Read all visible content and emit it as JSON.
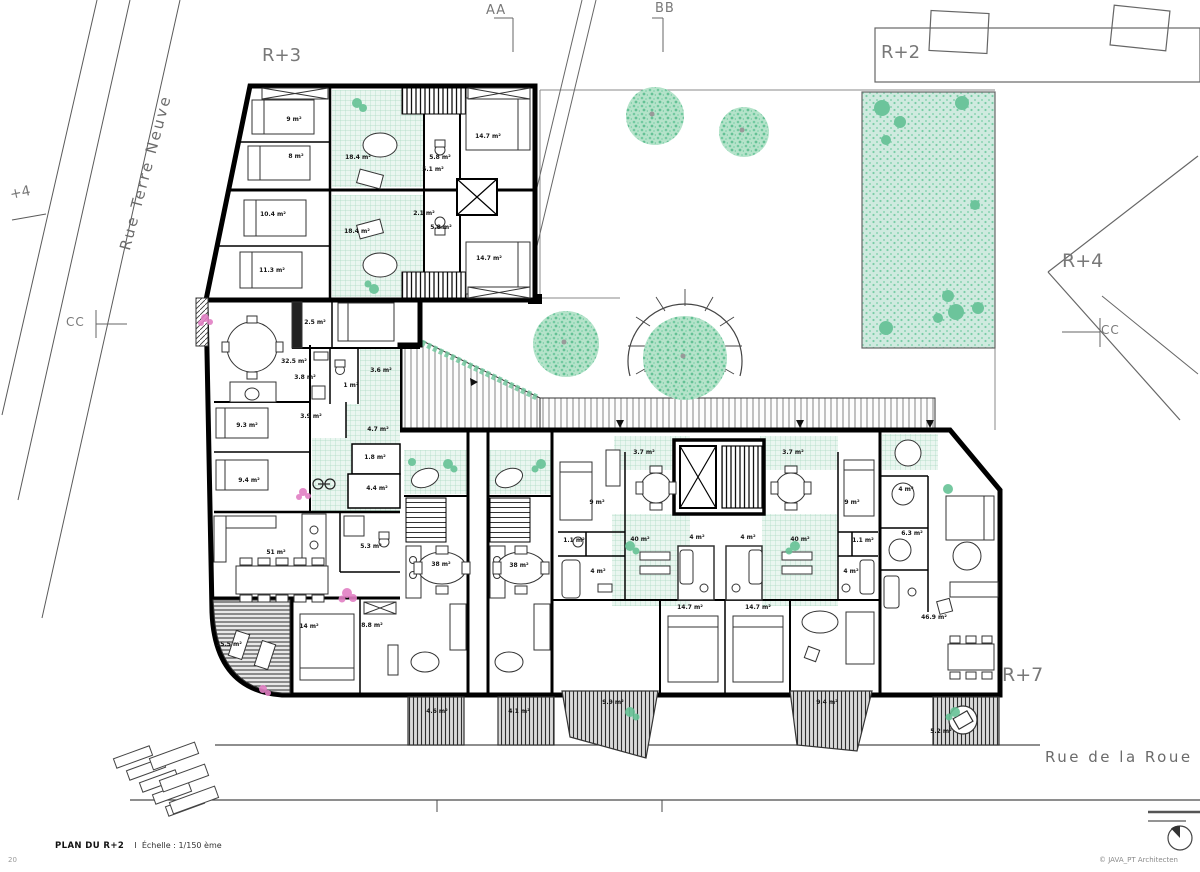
{
  "title_block": {
    "plan_title": "PLAN DU R+2",
    "separator": "I",
    "scale_label": "Échelle : 1/150 ème",
    "page_number": "20",
    "copyright": "© JAVA_PT Architecten"
  },
  "streets": {
    "left_street": "Rue Terre Neuve",
    "bottom_street": "Rue de la Roue"
  },
  "annotations": {
    "section_aa": "AA",
    "section_bb": "BB",
    "section_cc_left": "CC",
    "section_cc_right": "CC",
    "neighbor_r3": "R+3",
    "neighbor_r2": "R+2",
    "neighbor_r4": "R+4",
    "neighbor_r7": "R+7",
    "level_plus4": "+4"
  },
  "icons": {
    "compass": "north-compass",
    "elevator": "elevator-x",
    "bicycle": "bicycle"
  },
  "colors": {
    "wall": "#000000",
    "vegetation": "#7ecfa6",
    "tile_green": "#eaf6f0",
    "garden_green": "#cfeadf",
    "flower_pink": "#e27fc4",
    "annotation_grey": "#787878"
  },
  "rooms": [
    {
      "name": "bedroom",
      "area": "9 m²"
    },
    {
      "name": "bedroom",
      "area": "8 m²"
    },
    {
      "name": "living",
      "area": "18.4 m²"
    },
    {
      "name": "bath",
      "area": "5.1 m²"
    },
    {
      "name": "bath",
      "area": "5.8 m²"
    },
    {
      "name": "bedroom",
      "area": "14.7 m²"
    },
    {
      "name": "bedroom",
      "area": "10.4 m²"
    },
    {
      "name": "living",
      "area": "18.4 m²"
    },
    {
      "name": "wc",
      "area": "2.1 m²"
    },
    {
      "name": "bath",
      "area": "5.8 m²"
    },
    {
      "name": "bedroom",
      "area": "11.3 m²"
    },
    {
      "name": "bedroom",
      "area": "14.7 m²"
    },
    {
      "name": "closet",
      "area": "2.5 m²"
    },
    {
      "name": "living",
      "area": "32.5 m²"
    },
    {
      "name": "bath",
      "area": "3.8 m²"
    },
    {
      "name": "wc",
      "area": "1 m²"
    },
    {
      "name": "storage",
      "area": "3.6 m²"
    },
    {
      "name": "room",
      "area": "3.9 m²"
    },
    {
      "name": "bedroom",
      "area": "9.3 m²"
    },
    {
      "name": "hall",
      "area": "4.7 m²"
    },
    {
      "name": "wc",
      "area": "1.8 m²"
    },
    {
      "name": "bath",
      "area": "4.4 m²"
    },
    {
      "name": "bedroom",
      "area": "9.4 m²"
    },
    {
      "name": "living",
      "area": "51 m²"
    },
    {
      "name": "bath",
      "area": "5.3 m²"
    },
    {
      "name": "bedroom",
      "area": "14 m²"
    },
    {
      "name": "bedroom",
      "area": "8.8 m²"
    },
    {
      "name": "balcony",
      "area": "15.5 m²"
    },
    {
      "name": "living",
      "area": "38 m²"
    },
    {
      "name": "living",
      "area": "38 m²"
    },
    {
      "name": "terrace",
      "area": "3.7 m²"
    },
    {
      "name": "bedroom",
      "area": "9 m²"
    },
    {
      "name": "wc",
      "area": "1.1 m²"
    },
    {
      "name": "bath",
      "area": "4 m²"
    },
    {
      "name": "patio",
      "area": "40 m²"
    },
    {
      "name": "terrace",
      "area": "3.7 m²"
    },
    {
      "name": "bedroom",
      "area": "9 m²"
    },
    {
      "name": "wc",
      "area": "1.1 m²"
    },
    {
      "name": "bath",
      "area": "4 m²"
    },
    {
      "name": "bath",
      "area": "4 m²"
    },
    {
      "name": "patio",
      "area": "40 m²"
    },
    {
      "name": "bath",
      "area": "4 m²"
    },
    {
      "name": "bedroom",
      "area": "14.7 m²"
    },
    {
      "name": "bedroom",
      "area": "14.7 m²"
    },
    {
      "name": "room",
      "area": "4 m²"
    },
    {
      "name": "bedroom",
      "area": "6.3 m²"
    },
    {
      "name": "living",
      "area": "46.9 m²"
    },
    {
      "name": "balcony",
      "area": "4.6 m²"
    },
    {
      "name": "balcony",
      "area": "4.1 m²"
    },
    {
      "name": "balcony",
      "area": "9.9 m²"
    },
    {
      "name": "balcony",
      "area": "9.4 m²"
    },
    {
      "name": "balcony",
      "area": "5.2 m²"
    }
  ]
}
